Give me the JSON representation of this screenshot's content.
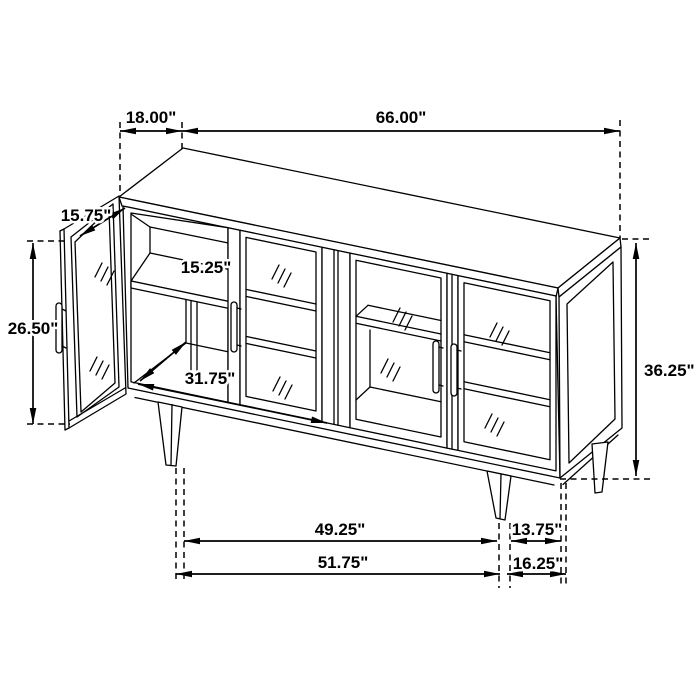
{
  "diagram": {
    "description": "Sideboard cabinet isometric line drawing with dimension callouts",
    "unit": "inches",
    "line_color": "#000000",
    "background_color": "#ffffff"
  },
  "dimensions": {
    "top_depth_label": "18.00\"",
    "top_width_label": "66.00\"",
    "door_width_label": "15.75\"",
    "door_height_label": "26.50\"",
    "shelf_depth_label": "15.25\"",
    "interior_width_label": "31.75\"",
    "cabinet_height_label": "36.25\"",
    "leg_span_label": "49.25\"",
    "leg_offset_label": "13.75\"",
    "base_width_label": "51.75\"",
    "side_offset_label": "16.25\""
  }
}
